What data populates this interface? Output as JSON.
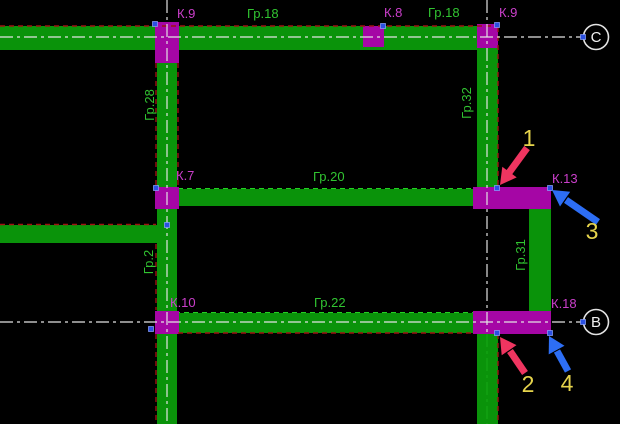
{
  "colors": {
    "background": "#000000",
    "beam": "#0a930a",
    "beam_edge": "#23d023",
    "beam_label": "#31c431",
    "column": "#a506a5",
    "column_label": "#cb3fcb",
    "axis": "#e3e3e3",
    "axis_green": "#14a614",
    "contour": "#9e1212",
    "grip": "#2b50e2",
    "grip_border": "#8fa6ff",
    "bubble_text": "#f0f0f0",
    "arrow_red": "#ef3560",
    "arrow_blue": "#2d6ef5",
    "callout": "#e6d44c"
  },
  "labels": {
    "k9_top_left": "К.9",
    "gr18_left": "Гр.18",
    "k8": "К.8",
    "gr18_right": "Гр.18",
    "k9_top_right": "К.9",
    "axis_c": "С",
    "gr28": "Гр.28",
    "gr32": "Гр.32",
    "k7": "К.7",
    "gr20": "Гр.20",
    "k13": "К.13",
    "gr2": "Гр.2",
    "gr31": "Гр.31",
    "k10": "К.10",
    "gr22": "Гр.22",
    "k18": "К.18",
    "axis_b": "В",
    "callout_1": "1",
    "callout_2": "2",
    "callout_3": "3",
    "callout_4": "4"
  }
}
